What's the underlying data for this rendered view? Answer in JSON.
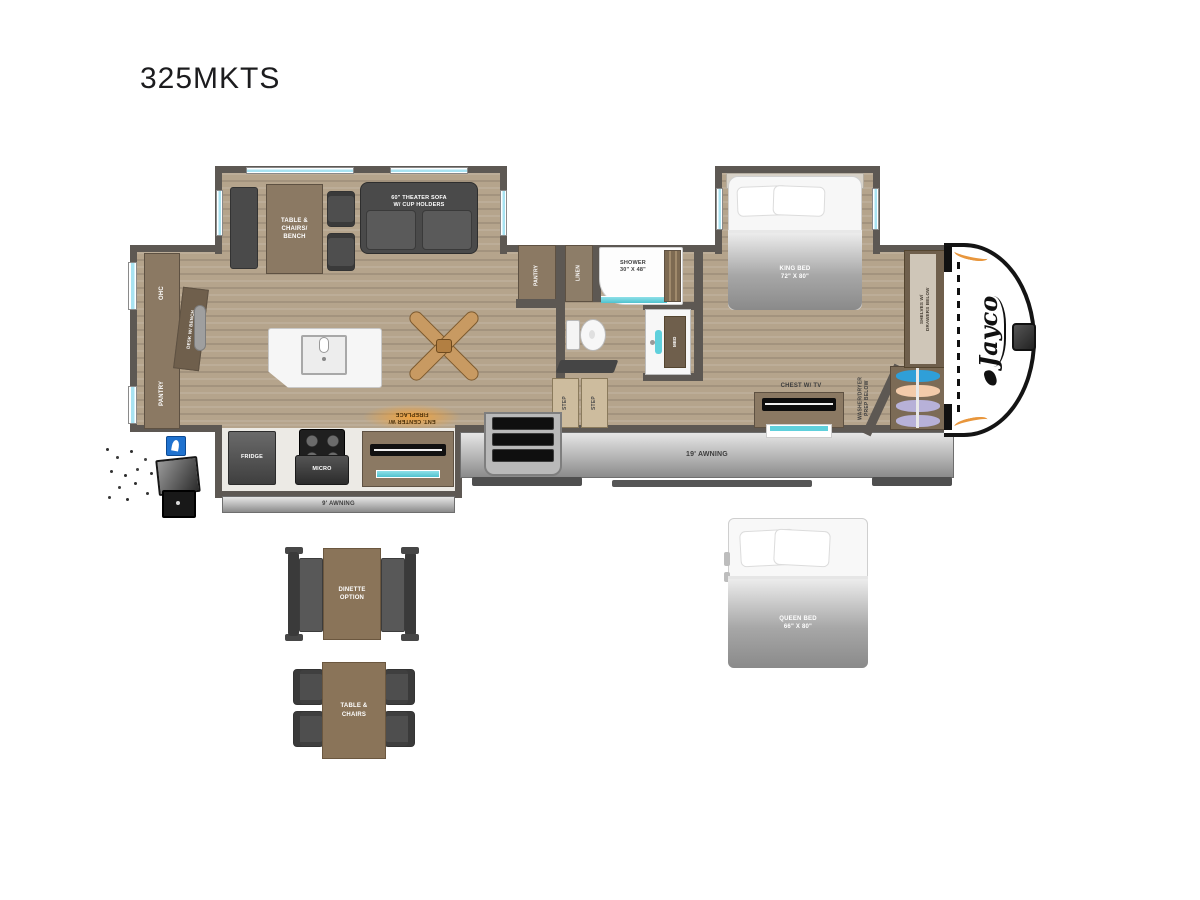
{
  "title": "325MKTS",
  "brand": {
    "logo_text": "Jayco"
  },
  "colors": {
    "wall": "#5d5853",
    "floor": "#b5a48c",
    "cabinet": "#8b7963",
    "cabinet_dark": "#6f5f4c",
    "dark_furniture": "#4c4c4c",
    "teal": "#5fd0dc",
    "window_blue": "#a8e3f2",
    "amber": "#f2a23a",
    "hanger_blue": "#2f9fd8",
    "hanger_peach": "#f3cbaa",
    "hanger_lavender": "#b7b1d8"
  },
  "main": {
    "living_slide": {
      "table_label": "TABLE &\nCHAIRS/\nBENCH",
      "sofa_label": "60\" THEATER SOFA\nW/ CUP HOLDERS"
    },
    "bedroom_slide": {
      "king_bed_label": "KING BED\n72\" X 80\""
    },
    "galley": {
      "fridge_label": "FRIDGE",
      "micro_label": "MICRO",
      "ent_center_label": "ENT. CENTER W/\nFIREPLACE",
      "awning_label": "9' AWNING"
    },
    "rear_wall": {
      "ohc_label": "OHC",
      "desk_label": "DESK W/ BENCH",
      "pantry_label": "PANTRY"
    },
    "bath": {
      "pantry_label": "PANTRY",
      "linen_label": "LINEN",
      "shower_label": "SHOWER\n30\" X 48\"",
      "med_label": "MED",
      "step1_label": "STEP",
      "step2_label": "STEP"
    },
    "bedroom": {
      "chest_label": "CHEST W/ TV",
      "washer_label": "WASHER/DRYER\nPREP BELOW",
      "shelves_label": "SHELVES W/\nDRAWERS BELOW"
    },
    "awning_label": "19' AWNING"
  },
  "options": {
    "dinette_label": "DINETTE\nOPTION",
    "table_chairs_label": "TABLE &\nCHAIRS",
    "queen_bed_label": "QUEEN BED\n66\" X 80\""
  }
}
